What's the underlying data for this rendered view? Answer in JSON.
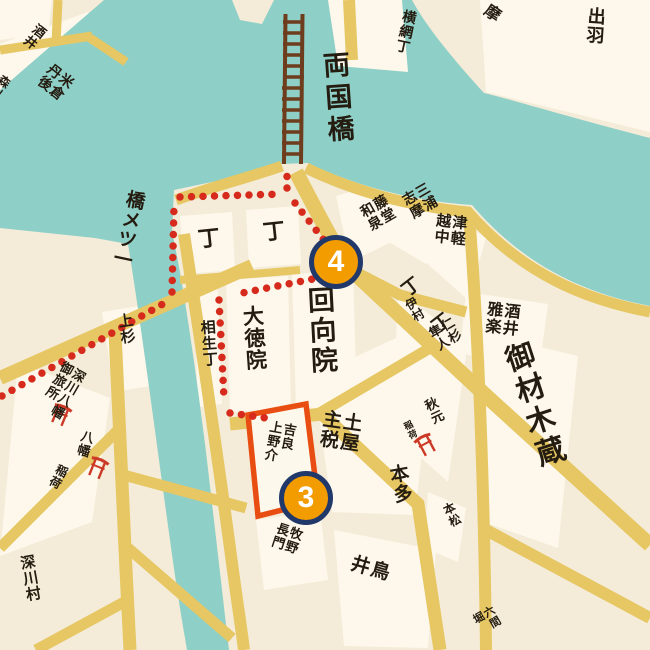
{
  "map": {
    "description": "Edo-period style tour map of Ryogoku / Honjo area with numbered walking-route stops",
    "colors": {
      "land": "#f4ecd8",
      "block_fill": "#fdf8eb",
      "water": "#8ecfc7",
      "road": "#e6c763",
      "ink": "#241c10",
      "route_dot": "#d62a1c",
      "highlight_box": "#e84d12",
      "marker_fill": "#f39c00",
      "marker_border": "#21386b",
      "bridge": "#6e3d1d",
      "torii": "#cc3926"
    },
    "icons": {
      "bridge": "ladder-bridge",
      "shrine": "torii-gate",
      "route": "red-dotted-line"
    },
    "markers": {
      "m4": {
        "number": "4"
      },
      "m3": {
        "number": "3"
      }
    },
    "labels": {
      "ryogokubashi": {
        "text": "両国橋"
      },
      "hitotsume": {
        "text": "一ツメ橋",
        "display": "橋メツ一"
      },
      "yokoami": {
        "text": "横網丁"
      },
      "dewa": {
        "text": "出羽"
      },
      "ma": {
        "text": "摩"
      },
      "cho1": {
        "text": "丁"
      },
      "cho2": {
        "text": "丁"
      },
      "cho3": {
        "text": "丁"
      },
      "cho4": {
        "text": "丁"
      },
      "ekoin": {
        "text": "回向院"
      },
      "daitokuin": {
        "text": "大徳院"
      },
      "aioicho": {
        "text": "相生丁"
      },
      "kira": {
        "text": "吉良上野介",
        "display": "吉良\n上野介"
      },
      "tsuchiya": {
        "text": "土屋主税",
        "display": "土屋\n主税"
      },
      "honda": {
        "text": "本多"
      },
      "makino": {
        "text": "牧野長門",
        "display": "牧野\n長門"
      },
      "toriiname": {
        "text": "鳥井",
        "display": "鳥\n井"
      },
      "honmatsu": {
        "text": "本松"
      },
      "rokkenbori": {
        "text": "六間堀",
        "display": "六間\n堀"
      },
      "zaimokugura": {
        "text": "御材木蔵"
      },
      "sakaiuta": {
        "text": "酒井雅楽",
        "display": "酒井\n雅楽"
      },
      "tsugaru": {
        "text": "津軽越中",
        "display": "津軽\n越中"
      },
      "miura": {
        "text": "三浦志摩",
        "display": "三浦\n志摩"
      },
      "todo": {
        "text": "藤堂和泉",
        "display": "藤堂\n和泉"
      },
      "nisugi": {
        "text": "仁杉隼人",
        "display": "仁杉\n隼人"
      },
      "imura": {
        "text": "伊村"
      },
      "akimoto": {
        "text": "秋元"
      },
      "inari1": {
        "text": "稲荷"
      },
      "uesugi": {
        "text": "上杉"
      },
      "otabisho": {
        "text": "深川八幡御旅所",
        "display": "深川八幡\n御旅所"
      },
      "hachiman": {
        "text": "八幡"
      },
      "inari2": {
        "text": "稲荷"
      },
      "fukagawamura": {
        "text": "深川村"
      },
      "yonekura": {
        "text": "米倉丹後",
        "display": "米倉\n丹後"
      },
      "sakaitl": {
        "text": "酒井"
      },
      "morikawa": {
        "text": "森川"
      }
    }
  }
}
